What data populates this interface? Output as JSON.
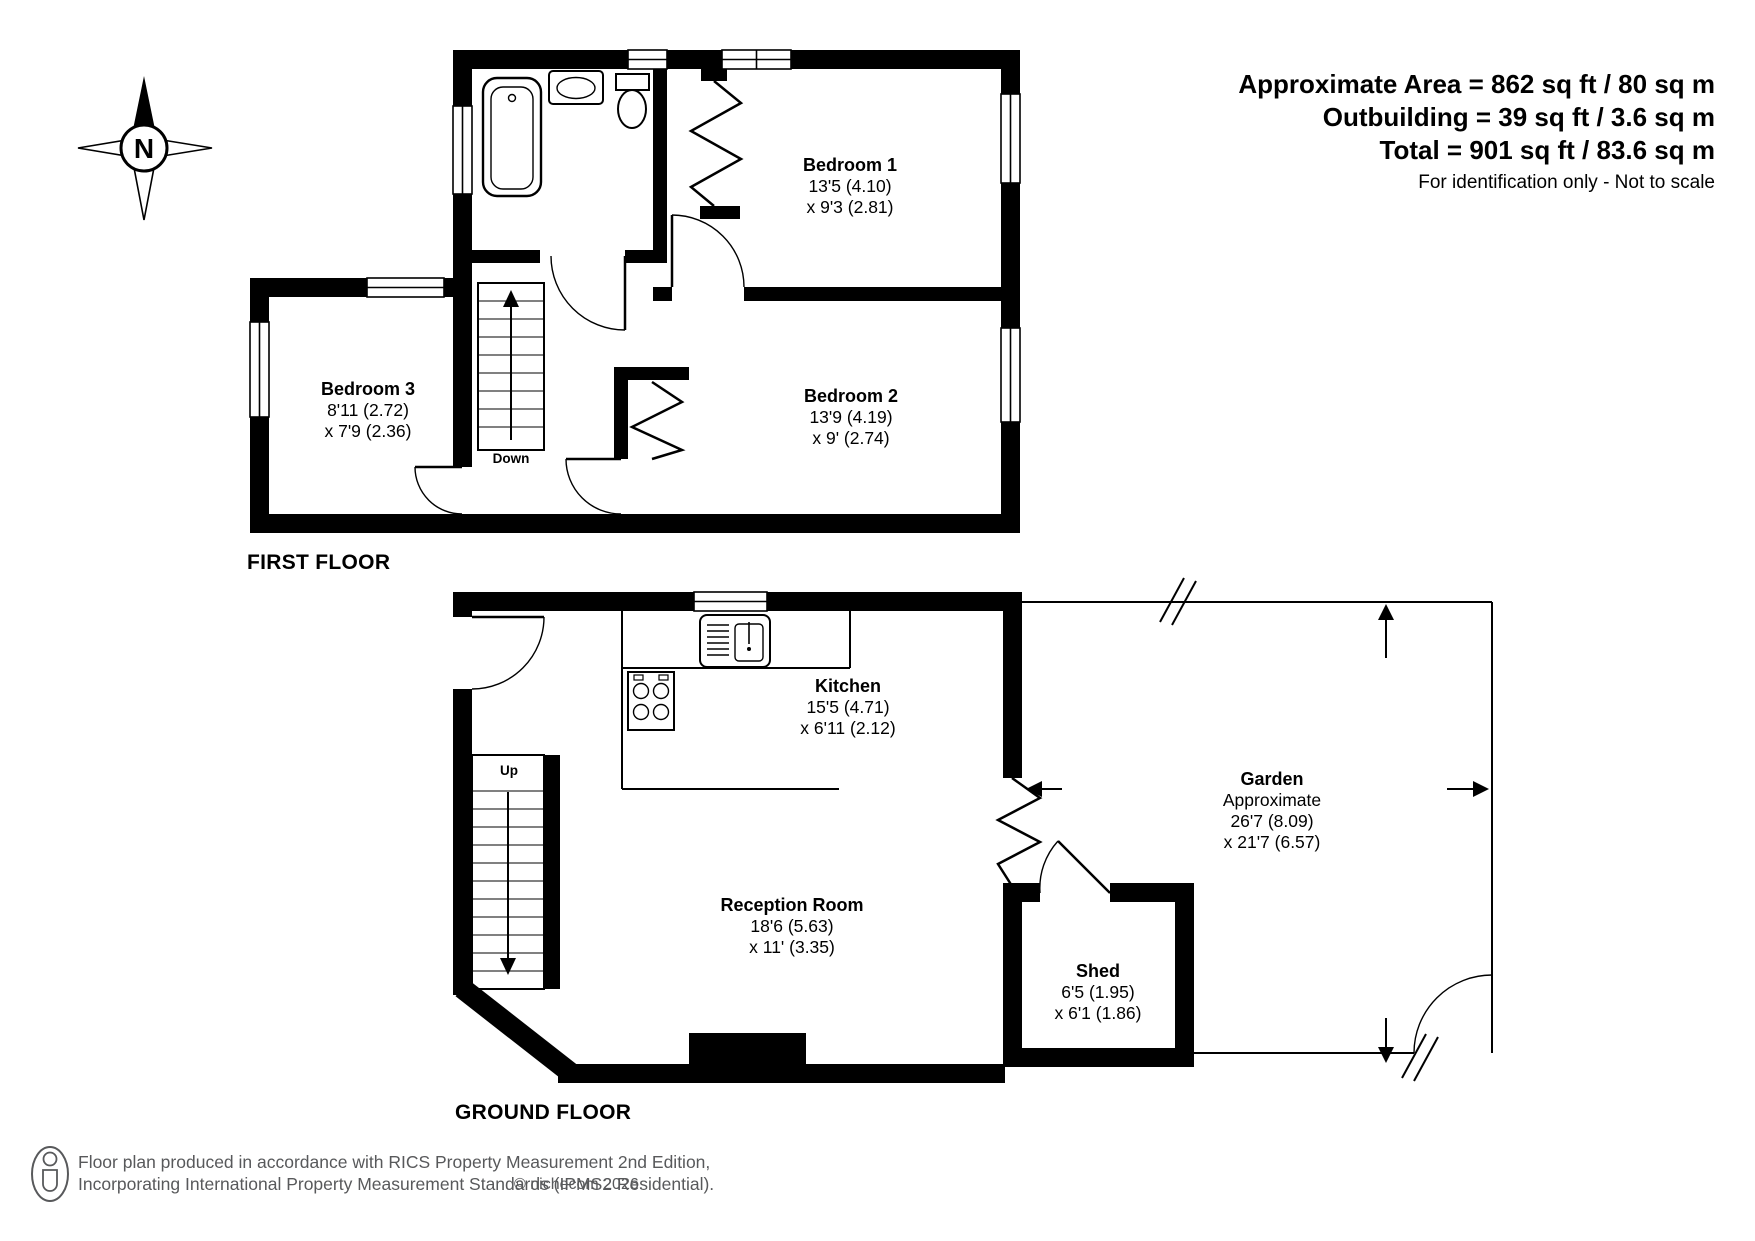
{
  "header": {
    "area_line": "Approximate Area = 862 sq ft / 80 sq m",
    "outbuilding_line": "Outbuilding = 39 sq ft / 3.6 sq m",
    "total_line": "Total = 901 sq ft / 83.6 sq m",
    "disclaimer": "For identification only - Not to scale"
  },
  "compass": {
    "north_label": "N"
  },
  "first_floor": {
    "title": "FIRST FLOOR",
    "stairs_label": "Down",
    "bedroom1": {
      "name": "Bedroom 1",
      "dim1": "13'5 (4.10)",
      "dim2": "x 9'3 (2.81)"
    },
    "bedroom2": {
      "name": "Bedroom 2",
      "dim1": "13'9 (4.19)",
      "dim2": "x 9' (2.74)"
    },
    "bedroom3": {
      "name": "Bedroom 3",
      "dim1": "8'11 (2.72)",
      "dim2": "x 7'9 (2.36)"
    }
  },
  "ground_floor": {
    "title": "GROUND FLOOR",
    "stairs_label": "Up",
    "kitchen": {
      "name": "Kitchen",
      "dim1": "15'5 (4.71)",
      "dim2": "x 6'11 (2.12)"
    },
    "reception": {
      "name": "Reception Room",
      "dim1": "18'6 (5.63)",
      "dim2": "x 11' (3.35)"
    },
    "shed": {
      "name": "Shed",
      "dim1": "6'5 (1.95)",
      "dim2": "x 6'1 (1.86)"
    },
    "garden": {
      "name": "Garden",
      "note": "Approximate",
      "dim1": "26'7 (8.09)",
      "dim2": "x 21'7 (6.57)"
    }
  },
  "footer": {
    "line1": "Floor plan produced in accordance with RICS Property Measurement 2nd Edition,",
    "line2": "Incorporating International Property Measurement Standards (IPMS2 Residential).",
    "copyright": "© nichecom 2026."
  },
  "colors": {
    "wall": "#000000",
    "background": "#ffffff",
    "muted_text": "#58595b"
  }
}
